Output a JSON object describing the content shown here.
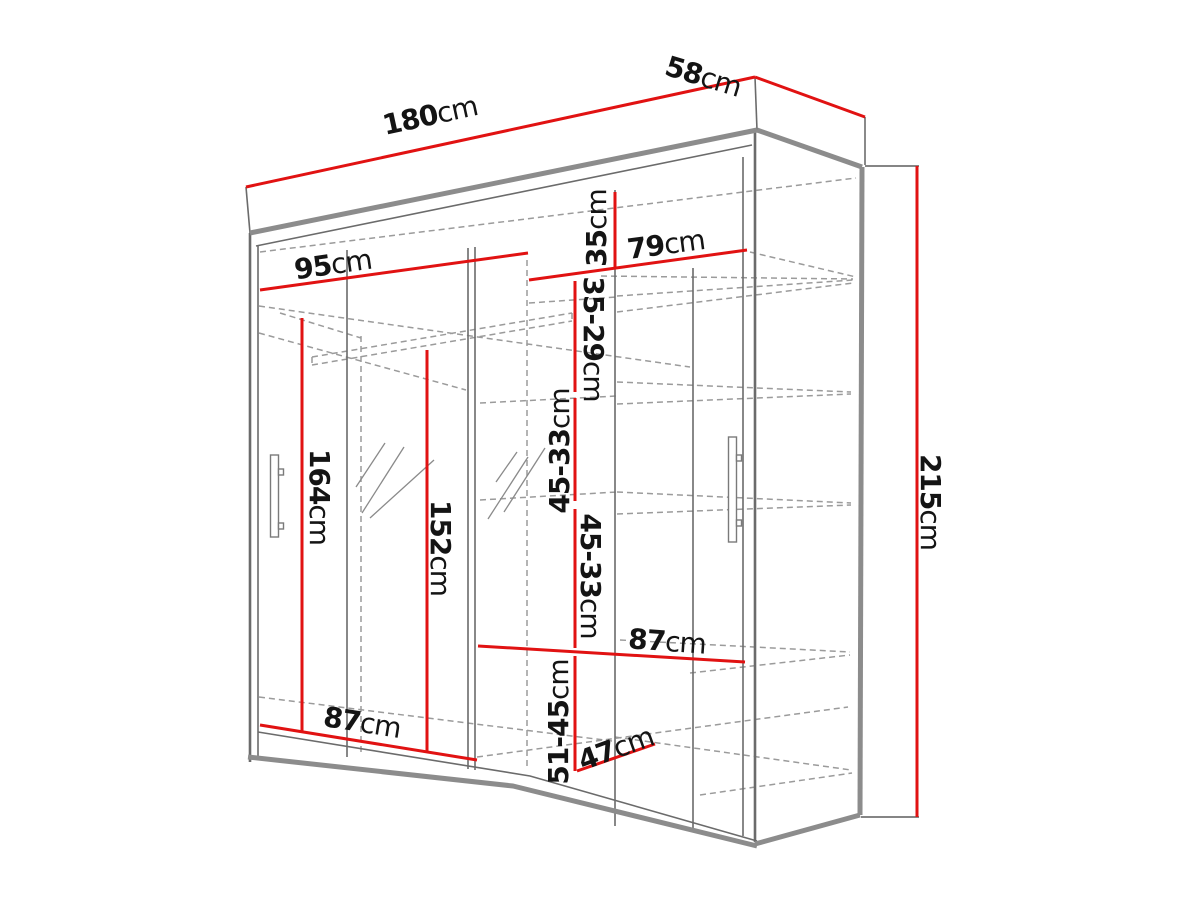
{
  "diagram": {
    "kind": "wardrobe-dimension-drawing",
    "unit": "cm"
  },
  "colors": {
    "dimension-red": "#e11212",
    "outline-gray": "#8c8c8c",
    "line-gray": "#6b6b6b",
    "dashed-gray": "#9b9b9b",
    "label-black": "#141414",
    "bg": "#ffffff"
  },
  "labels": {
    "w180": {
      "value": "180",
      "unit": "cm"
    },
    "d58": {
      "value": "58",
      "unit": "cm"
    },
    "h215": {
      "value": "215",
      "unit": "cm"
    },
    "w95": {
      "value": "95",
      "unit": "cm"
    },
    "w79": {
      "value": "79",
      "unit": "cm"
    },
    "h35": {
      "value": "35",
      "unit": "cm"
    },
    "h3529": {
      "value": "35-29",
      "unit": "cm"
    },
    "h4533a": {
      "value": "45-33",
      "unit": "cm"
    },
    "h4533b": {
      "value": "45-33",
      "unit": "cm"
    },
    "h164": {
      "value": "164",
      "unit": "cm"
    },
    "h152": {
      "value": "152",
      "unit": "cm"
    },
    "h5145": {
      "value": "51-45",
      "unit": "cm"
    },
    "w47": {
      "value": "47",
      "unit": "cm"
    },
    "w87right": {
      "value": "87",
      "unit": "cm"
    },
    "w87bottom": {
      "value": "87",
      "unit": "cm"
    }
  }
}
